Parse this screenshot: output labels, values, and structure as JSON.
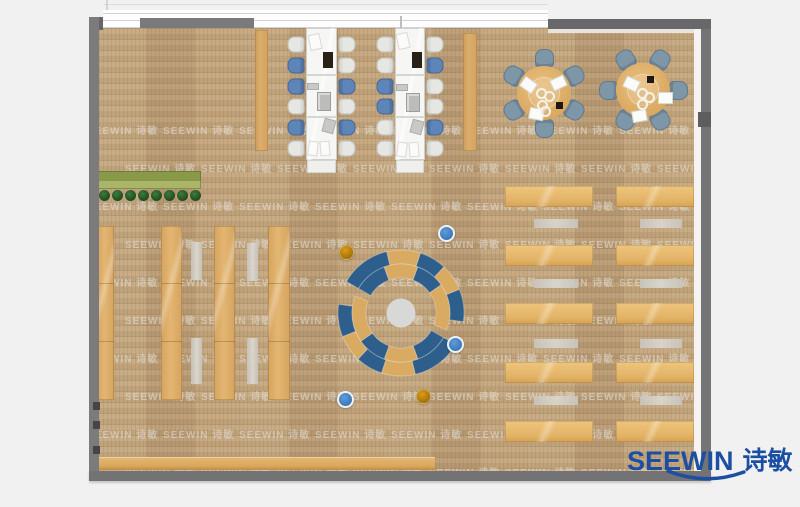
{
  "logo": {
    "brand": "SEEWIN",
    "brand_cn": "诗敏",
    "color": "#1c4fa2"
  },
  "watermark": {
    "text": "SEEWIN 诗敏"
  },
  "colors": {
    "floor": "#c2a378",
    "wall": "#757578",
    "wood_furniture": "#ddae6a",
    "ring_blue": "#2d5e8c",
    "ring_tan": "#d9aa62",
    "chair_blue": "#5e85b8",
    "chair_white": "#e6e6e3",
    "round_chair": "#7d96a8",
    "dot_blue": "#3a76b5",
    "dot_orange": "#b57c08",
    "planter_green": "#89994a"
  },
  "floorplan": {
    "room": {
      "x": 99,
      "y": 28,
      "w": 595,
      "h": 443
    },
    "panels": [
      {
        "x": 255,
        "y": 30,
        "w": 13,
        "h": 121
      },
      {
        "x": 463,
        "y": 33,
        "w": 14,
        "h": 118
      }
    ],
    "clusters": [
      {
        "table_x": 306,
        "table_y": 28,
        "table_w": 31,
        "table_h": 132,
        "cap_h": 13,
        "left_chair_x": 288,
        "right_chair_x": 339,
        "rows_y": [
          36,
          57,
          78,
          98,
          119,
          140
        ],
        "left": [
          "w",
          "b",
          "b",
          "w",
          "b",
          "w"
        ],
        "right": [
          "w",
          "w",
          "b",
          "w",
          "b",
          "w"
        ],
        "items": [
          {
            "x": 310,
            "y": 35,
            "w": 10,
            "h": 14,
            "t": "paper",
            "r": -12
          },
          {
            "x": 323,
            "y": 52,
            "w": 10,
            "h": 16,
            "t": "laptop",
            "r": 0
          },
          {
            "x": 307,
            "y": 83,
            "w": 12,
            "h": 7,
            "t": "grayitem",
            "r": 0
          },
          {
            "x": 317,
            "y": 92,
            "w": 14,
            "h": 19,
            "t": "device",
            "r": 0
          },
          {
            "x": 323,
            "y": 119,
            "w": 12,
            "h": 14,
            "t": "grayitem",
            "r": 15
          },
          {
            "x": 309,
            "y": 142,
            "w": 8,
            "h": 13,
            "t": "paper",
            "r": 8
          },
          {
            "x": 321,
            "y": 142,
            "w": 8,
            "h": 13,
            "t": "paper",
            "r": -5
          }
        ]
      },
      {
        "table_x": 395,
        "table_y": 28,
        "table_w": 30,
        "table_h": 132,
        "cap_h": 13,
        "left_chair_x": 377,
        "right_chair_x": 427,
        "rows_y": [
          36,
          57,
          78,
          98,
          119,
          140
        ],
        "left": [
          "w",
          "w",
          "b",
          "b",
          "w",
          "w"
        ],
        "right": [
          "w",
          "b",
          "w",
          "w",
          "b",
          "w"
        ],
        "items": [
          {
            "x": 398,
            "y": 34,
            "w": 10,
            "h": 14,
            "t": "paper",
            "r": -12
          },
          {
            "x": 412,
            "y": 52,
            "w": 10,
            "h": 16,
            "t": "laptop",
            "r": 0
          },
          {
            "x": 396,
            "y": 84,
            "w": 12,
            "h": 7,
            "t": "grayitem",
            "r": 0
          },
          {
            "x": 406,
            "y": 93,
            "w": 14,
            "h": 19,
            "t": "device",
            "r": 0
          },
          {
            "x": 411,
            "y": 120,
            "w": 12,
            "h": 14,
            "t": "grayitem",
            "r": 15
          },
          {
            "x": 398,
            "y": 143,
            "w": 8,
            "h": 13,
            "t": "paper",
            "r": 8
          },
          {
            "x": 410,
            "y": 143,
            "w": 8,
            "h": 13,
            "t": "paper",
            "r": -5
          }
        ]
      }
    ],
    "round_tables": [
      {
        "cx": 544,
        "cy": 93,
        "r": 27,
        "chair_r": 35,
        "chair_size": 19,
        "chair_angles": [
          90,
          150,
          210,
          270,
          330,
          30
        ],
        "papers": [
          {
            "dx": -22,
            "dy": -13,
            "r": 35
          },
          {
            "dx": 8,
            "dy": -15,
            "r": -25
          },
          {
            "dx": -14,
            "dy": 16,
            "r": 10
          }
        ],
        "cups": [
          {
            "dx": -8,
            "dy": -5
          },
          {
            "dx": 0,
            "dy": -2
          },
          {
            "dx": -7,
            "dy": 7
          },
          {
            "dx": -4,
            "dy": 13
          }
        ],
        "dark": {
          "dx": 12,
          "dy": 9
        }
      },
      {
        "cx": 643,
        "cy": 90,
        "r": 27,
        "chair_r": 35,
        "chair_size": 19,
        "chair_angles": [
          0,
          60,
          120,
          180,
          240,
          300
        ],
        "papers": [
          {
            "dx": -18,
            "dy": -11,
            "r": 25
          },
          {
            "dx": 16,
            "dy": 3,
            "r": 0
          },
          {
            "dx": -10,
            "dy": 21,
            "r": -10
          }
        ],
        "cups": [
          {
            "dx": -6,
            "dy": -2
          },
          {
            "dx": 1,
            "dy": 2
          },
          {
            "dx": -6,
            "dy": 9
          }
        ],
        "dark": {
          "dx": 4,
          "dy": -14
        }
      }
    ],
    "planter": {
      "x": 98,
      "y": 171,
      "w": 103,
      "h": 18,
      "bushes": 8,
      "bush_y": 195,
      "bush_x0": 104,
      "bush_dx": 13,
      "bush_r": 5.5
    },
    "shelves": {
      "y": 226,
      "h": 174,
      "seg_offsets": [
        57,
        115
      ],
      "strips": [
        {
          "x": 97,
          "w": 17
        },
        {
          "x": 161,
          "w": 21
        },
        {
          "x": 214,
          "w": 21
        },
        {
          "x": 268,
          "w": 22
        }
      ],
      "benches": [
        {
          "x": 191,
          "y": 242,
          "h": 38
        },
        {
          "x": 247,
          "y": 243,
          "h": 38
        },
        {
          "x": 191,
          "y": 338,
          "h": 46
        },
        {
          "x": 247,
          "y": 338,
          "h": 46
        }
      ],
      "bench_w": 11
    },
    "ring": {
      "cx": 401,
      "cy": 313,
      "r1": 35,
      "r2": 49,
      "r3": 63,
      "center_r": 14.5,
      "rotations": [
        0,
        180
      ],
      "outer": [
        {
          "a1": 150,
          "a2": 103,
          "c": "blue"
        },
        {
          "a1": 103,
          "a2": 72,
          "c": "tan"
        },
        {
          "a1": 72,
          "a2": 47,
          "c": "blue"
        },
        {
          "a1": 47,
          "a2": 22,
          "c": "tan"
        },
        {
          "a1": 22,
          "a2": -8,
          "c": "blue"
        }
      ],
      "inner": [
        {
          "a1": 150,
          "a2": 110,
          "c": "blue"
        },
        {
          "a1": 110,
          "a2": 70,
          "c": "tan"
        },
        {
          "a1": 70,
          "a2": 35,
          "c": "blue"
        },
        {
          "a1": 35,
          "a2": -20,
          "c": "tan"
        }
      ]
    },
    "dots": [
      {
        "x": 444,
        "y": 231,
        "c": "blue"
      },
      {
        "x": 453,
        "y": 342,
        "c": "blue"
      },
      {
        "x": 343,
        "y": 397,
        "c": "blue"
      },
      {
        "x": 345,
        "y": 251,
        "c": "orange"
      },
      {
        "x": 422,
        "y": 395,
        "c": "orange"
      }
    ],
    "study_area": {
      "columns": [
        {
          "x": 505,
          "w": 88
        },
        {
          "x": 616,
          "w": 78
        }
      ],
      "rows_y": [
        186,
        245,
        303,
        362,
        421
      ],
      "desk_h": 21,
      "bench_cols": [
        {
          "x": 534,
          "w": 44
        },
        {
          "x": 640,
          "w": 42
        }
      ],
      "bench_rows_y": [
        219,
        279,
        339,
        396
      ],
      "bench_h": 9
    },
    "counter": {
      "x": 99,
      "y": 457,
      "w": 336,
      "h": 13
    },
    "wall_marks_y": [
      402,
      421,
      446
    ],
    "watermark_grid": {
      "y0": 94,
      "dy": 38,
      "x0": -12,
      "dx": 76,
      "row_shift": 38
    }
  }
}
